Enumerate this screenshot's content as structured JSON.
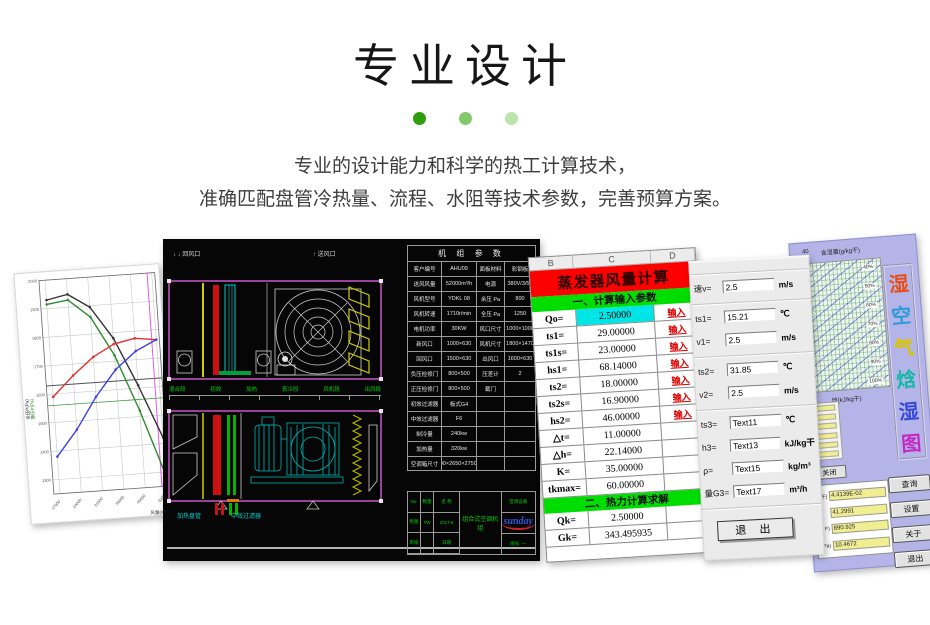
{
  "header": {
    "title": "专业设计",
    "dots": [
      "#2f9e0c",
      "#82c96a",
      "#bde3ad"
    ]
  },
  "description": {
    "line1": "专业的设计能力和科学的热工计算技术，",
    "line2": "准确匹配盘管冷热量、流程、水阻等技术参数，完善预算方案。"
  },
  "chart_data": [
    {
      "id": "fan_performance",
      "type": "line",
      "title": "风机性能曲线",
      "xlabel": "风量(m³/h)",
      "ylabels": [
        {
          "text": "全压P(Pa)",
          "color": "#222222"
        },
        {
          "text": "静压P(Pa)",
          "color": "#2e8b2e"
        }
      ],
      "grid": true,
      "xlim": [
        15000,
        53000
      ],
      "ylim": [
        1250,
        2000
      ],
      "xticks": [
        17000,
        24000,
        31000,
        38000,
        45000,
        52000
      ],
      "ytick_step": 100,
      "x": [
        17000,
        24000,
        31000,
        38000,
        45000,
        52000
      ],
      "series": [
        {
          "name": "全压曲线",
          "color": "#333333",
          "values": [
            1930,
            1945,
            1895,
            1780,
            1610,
            1420
          ]
        },
        {
          "name": "静压曲线",
          "color": "#2e8b2e",
          "values": [
            1915,
            1925,
            1860,
            1720,
            1520,
            1290
          ]
        },
        {
          "name": "红色曲线",
          "color": "#e03030",
          "values": [
            1590,
            1660,
            1720,
            1760,
            1775,
            1765
          ]
        },
        {
          "name": "蓝色曲线",
          "color": "#4040e0",
          "values": [
            1380,
            1470,
            1580,
            1670,
            1730,
            1765
          ]
        }
      ],
      "ref_lines": {
        "h_gray": 1630,
        "h_green": 1560,
        "v_magenta": 50500
      }
    },
    {
      "id": "psychrometric",
      "type": "area",
      "title": "湿空气焓湿图",
      "xlabel": "焓(kJ/kg干)",
      "ylabel": "含湿量(g/kg干)",
      "rh_labels": [
        "40%",
        "50%",
        "60%",
        "70%",
        "80%",
        "90%",
        "100%"
      ]
    }
  ],
  "cad": {
    "arrow_left": "↓ ↓ 回风口",
    "arrow_right": "↑ 送风口",
    "green_row": [
      "混合段",
      "初效",
      "加热",
      "表冷段",
      "风机段",
      "出风段"
    ],
    "cyan_labels": [
      "加热盘管",
      "中效过滤器"
    ],
    "table_title": "机 组 参 数",
    "table_rows": [
      {
        "c1": "客户编号",
        "c2": "AHU09",
        "c3": "面板材料",
        "c4": "彩钢板"
      },
      {
        "c1": "送风风量",
        "c2": "52000m³/h",
        "c3": "电源",
        "c4": "380V/3/50"
      },
      {
        "c1": "风机型号",
        "c2": "YDKL 08",
        "c3": "余压 Pa",
        "c4": "800"
      },
      {
        "c1": "风机转速",
        "c2": "1710r/min",
        "c3": "全压 Pa",
        "c4": "1250"
      },
      {
        "c1": "电机功率",
        "c2": "30KW",
        "c3": "风口尺寸",
        "c4": "1000×1000"
      },
      {
        "c1": "新风口",
        "c2": "1000×630",
        "c3": "风机尺寸",
        "c4": "1800×1470"
      },
      {
        "c1": "回风口",
        "c2": "1500×630",
        "c3": "出风口",
        "c4": "1600×630"
      },
      {
        "c1": "负压检修门",
        "c2": "800×500",
        "c3": "压差计",
        "c4": "2"
      },
      {
        "c1": "正压检修门",
        "c2": "800×500",
        "c3": "截门",
        "c4": ""
      },
      {
        "c1": "初效过滤器",
        "c2": "板式G4",
        "c3": "",
        "c4": ""
      },
      {
        "c1": "中效过滤器",
        "c2": "F6",
        "c3": "",
        "c4": ""
      },
      {
        "c1": "制冷量",
        "c2": "240kw",
        "c3": "",
        "c4": ""
      },
      {
        "c1": "加热量",
        "c2": "320kw",
        "c3": "",
        "c4": ""
      },
      {
        "c1": "空调箱尺寸",
        "c2": "6500×2650×2750(H)",
        "c3": "",
        "c4": ""
      }
    ],
    "title_block": {
      "left_cells": [
        "No.",
        "数量",
        "名 称",
        "制图",
        "TW",
        "2017.6",
        "审核",
        "",
        "日期"
      ],
      "center": "组合式空调机组",
      "right_top": "空调设备",
      "logo": "sunday",
      "right_bottom": "图号: —"
    }
  },
  "spreadsheet": {
    "columns": [
      "B",
      "C",
      "D"
    ],
    "title": "蒸发器风量计算",
    "section1": "一、计算输入参数",
    "rows1": [
      {
        "label": "Qo=",
        "value": "2.50000",
        "action": "输入"
      },
      {
        "label": "ts1=",
        "value": "29.00000",
        "action": "输入"
      },
      {
        "label": "ts1s=",
        "value": "23.00000",
        "action": "输入"
      },
      {
        "label": "hs1=",
        "value": "68.14000",
        "action": "输入"
      },
      {
        "label": "ts2=",
        "value": "18.00000",
        "action": "输入"
      },
      {
        "label": "ts2s=",
        "value": "16.90000",
        "action": "输入"
      },
      {
        "label": "hs2=",
        "value": "46.00000",
        "action": "输入"
      },
      {
        "label": "△t=",
        "value": "11.00000",
        "action": ""
      },
      {
        "label": "△h=",
        "value": "22.14000",
        "action": ""
      },
      {
        "label": "K=",
        "value": "35.00000",
        "action": ""
      },
      {
        "label": "tkmax=",
        "value": "60.00000",
        "action": ""
      }
    ],
    "section2": "二、热力计算求解",
    "rows2": [
      {
        "label": "Qk=",
        "value": "2.50000",
        "action": ""
      },
      {
        "label": "Gk=",
        "value": "343.495935",
        "action": ""
      }
    ]
  },
  "form": {
    "group1": [
      {
        "label": "速v=",
        "value": "2.5",
        "unit": "m/s"
      }
    ],
    "group2": [
      {
        "label": "ts1=",
        "value": "15.21",
        "unit": "℃"
      },
      {
        "label": "v1=",
        "value": "2.5",
        "unit": "m/s"
      }
    ],
    "group3": [
      {
        "label": "ts2=",
        "value": "31.85",
        "unit": "℃"
      },
      {
        "label": "v2=",
        "value": "2.5",
        "unit": "m/s"
      }
    ],
    "group4": [
      {
        "label": "ts3=",
        "value": "Text11",
        "unit": "℃"
      },
      {
        "label": "h3=",
        "value": "Text13",
        "unit": "kJ/kg干"
      },
      {
        "label": "ρ=",
        "value": "Text15",
        "unit": "kg/m³"
      },
      {
        "label": "量G3=",
        "value": "Text17",
        "unit": "m³/h"
      }
    ],
    "exit_label": "退 出"
  },
  "psychro_app": {
    "tick_label": "40",
    "humidity_label": "含湿量(g/kg干)",
    "enthalpy_label": "焓(kJ/kg干)",
    "rh_labels": [
      "40%",
      "50%",
      "60%",
      "70%",
      "80%",
      "90%",
      "100%"
    ],
    "title_chars": [
      {
        "ch": "湿",
        "color": "#e8501a"
      },
      {
        "ch": "空",
        "color": "#2e9ad8"
      },
      {
        "ch": "气",
        "color": "#d8c400"
      },
      {
        "ch": "焓",
        "color": "#14b8a8"
      },
      {
        "ch": "湿",
        "color": "#3a4ad8"
      },
      {
        "ch": "图",
        "color": "#c22ac2"
      }
    ],
    "close_label": "关闭",
    "values": [
      {
        "label": "干)",
        "value": "4.4139E-02"
      },
      {
        "label": "",
        "value": "41.2991"
      },
      {
        "label": "F)",
        "value": "890.925"
      },
      {
        "label": "Pa)",
        "value": "10.4672"
      }
    ],
    "buttons": [
      "查询",
      "设置",
      "关于",
      "退出"
    ]
  }
}
